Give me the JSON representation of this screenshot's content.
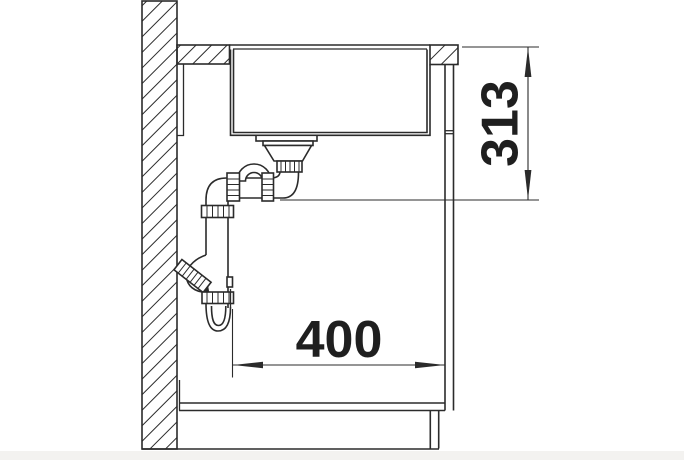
{
  "drawing": {
    "kind": "technical-drawing",
    "dimensions": {
      "vertical": {
        "value": "313",
        "orientation": "vertical"
      },
      "horizontal": {
        "value": "400",
        "orientation": "horizontal"
      }
    },
    "colors": {
      "line": "#2b2b2b",
      "text": "#1f1f1f",
      "background": "#ffffff",
      "footer_strip": "#f3f2f0"
    }
  }
}
